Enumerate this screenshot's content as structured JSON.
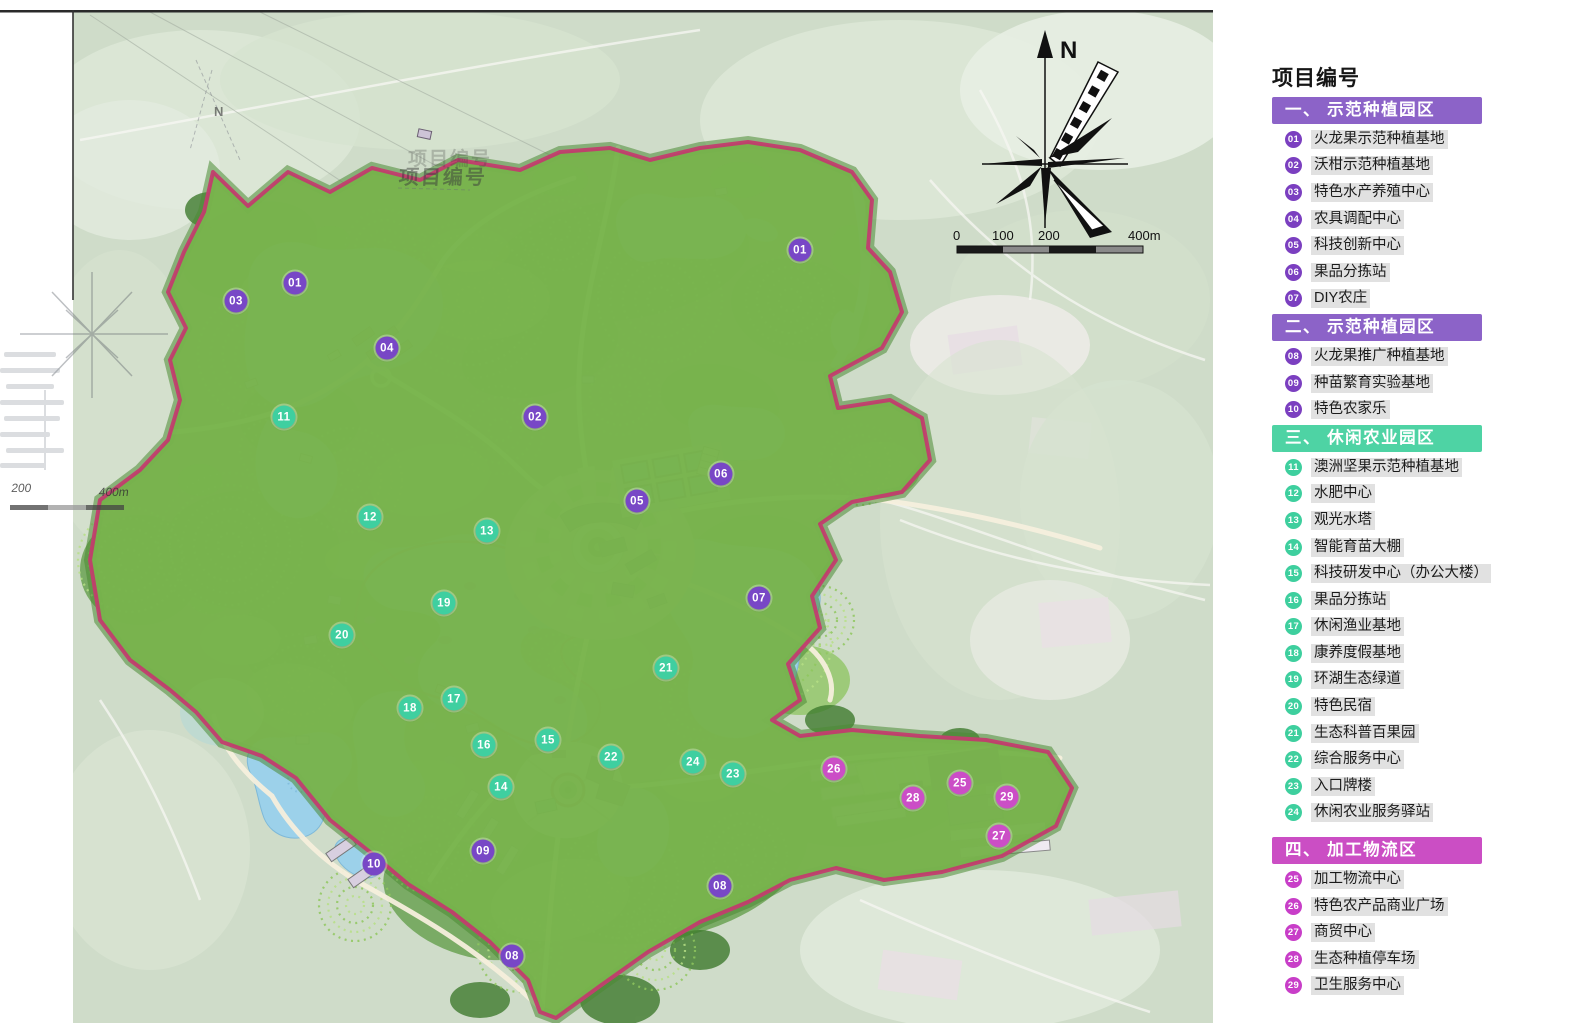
{
  "map": {
    "compass_label": "N",
    "scalebar": {
      "l0": "0",
      "l1": "100",
      "l2": "200",
      "l3": "400m"
    },
    "ghost": {
      "title_line1": "项目编号",
      "title_line2": "项目编号",
      "north_label": "N",
      "scale_200": "200",
      "scale_400": "400m"
    },
    "marker_colors": {
      "purple": "#7847c6",
      "teal": "#3fcfa0",
      "magenta": "#cb4ec6"
    },
    "markers": [
      {
        "id": "01",
        "group": "purple",
        "x": 295,
        "y": 283
      },
      {
        "id": "01",
        "group": "purple",
        "x": 800,
        "y": 250
      },
      {
        "id": "02",
        "group": "purple",
        "x": 535,
        "y": 417
      },
      {
        "id": "03",
        "group": "purple",
        "x": 236,
        "y": 301
      },
      {
        "id": "04",
        "group": "purple",
        "x": 387,
        "y": 348
      },
      {
        "id": "05",
        "group": "purple",
        "x": 637,
        "y": 501
      },
      {
        "id": "06",
        "group": "purple",
        "x": 721,
        "y": 474
      },
      {
        "id": "07",
        "group": "purple",
        "x": 759,
        "y": 598
      },
      {
        "id": "08",
        "group": "purple",
        "x": 720,
        "y": 886
      },
      {
        "id": "08",
        "group": "purple",
        "x": 512,
        "y": 956
      },
      {
        "id": "09",
        "group": "purple",
        "x": 483,
        "y": 851
      },
      {
        "id": "10",
        "group": "purple",
        "x": 374,
        "y": 864
      },
      {
        "id": "11",
        "group": "teal",
        "x": 284,
        "y": 417
      },
      {
        "id": "12",
        "group": "teal",
        "x": 370,
        "y": 517
      },
      {
        "id": "13",
        "group": "teal",
        "x": 487,
        "y": 531
      },
      {
        "id": "14",
        "group": "teal",
        "x": 501,
        "y": 787
      },
      {
        "id": "15",
        "group": "teal",
        "x": 548,
        "y": 740
      },
      {
        "id": "16",
        "group": "teal",
        "x": 484,
        "y": 745
      },
      {
        "id": "17",
        "group": "teal",
        "x": 454,
        "y": 699
      },
      {
        "id": "18",
        "group": "teal",
        "x": 410,
        "y": 708
      },
      {
        "id": "19",
        "group": "teal",
        "x": 444,
        "y": 603
      },
      {
        "id": "20",
        "group": "teal",
        "x": 342,
        "y": 635
      },
      {
        "id": "21",
        "group": "teal",
        "x": 666,
        "y": 668
      },
      {
        "id": "22",
        "group": "teal",
        "x": 611,
        "y": 757
      },
      {
        "id": "23",
        "group": "teal",
        "x": 733,
        "y": 774
      },
      {
        "id": "24",
        "group": "teal",
        "x": 693,
        "y": 762
      },
      {
        "id": "25",
        "group": "magenta",
        "x": 960,
        "y": 783
      },
      {
        "id": "26",
        "group": "magenta",
        "x": 834,
        "y": 769
      },
      {
        "id": "27",
        "group": "magenta",
        "x": 999,
        "y": 836
      },
      {
        "id": "28",
        "group": "magenta",
        "x": 913,
        "y": 798
      },
      {
        "id": "29",
        "group": "magenta",
        "x": 1007,
        "y": 797
      }
    ]
  },
  "legend": {
    "title": "项目编号",
    "circle_colors": {
      "purple": "#7b3fc0",
      "teal": "#3ecf9e",
      "magenta": "#c83ec8"
    },
    "sections": [
      {
        "heading": "一、 示范种植园区",
        "color": "#8c63c8",
        "group": "purple",
        "items": [
          {
            "id": "01",
            "label": "火龙果示范种植基地"
          },
          {
            "id": "02",
            "label": "沃柑示范种植基地"
          },
          {
            "id": "03",
            "label": "特色水产养殖中心"
          },
          {
            "id": "04",
            "label": "农具调配中心"
          },
          {
            "id": "05",
            "label": "科技创新中心"
          },
          {
            "id": "06",
            "label": "果品分拣站"
          },
          {
            "id": "07",
            "label": "DIY农庄"
          }
        ]
      },
      {
        "heading": "二、 示范种植园区",
        "color": "#8c63c8",
        "group": "purple",
        "items": [
          {
            "id": "08",
            "label": "火龙果推广种植基地"
          },
          {
            "id": "09",
            "label": "种苗繁育实验基地"
          },
          {
            "id": "10",
            "label": "特色农家乐"
          }
        ]
      },
      {
        "heading": "三、 休闲农业园区",
        "color": "#4ed3a4",
        "group": "teal",
        "items": [
          {
            "id": "11",
            "label": "澳洲坚果示范种植基地"
          },
          {
            "id": "12",
            "label": "水肥中心"
          },
          {
            "id": "13",
            "label": "观光水塔"
          },
          {
            "id": "14",
            "label": "智能育苗大棚"
          },
          {
            "id": "15",
            "label": "科技研发中心（办公大楼）"
          },
          {
            "id": "16",
            "label": "果品分拣站"
          },
          {
            "id": "17",
            "label": "休闲渔业基地"
          },
          {
            "id": "18",
            "label": "康养度假基地"
          },
          {
            "id": "19",
            "label": "环湖生态绿道"
          },
          {
            "id": "20",
            "label": "特色民宿"
          },
          {
            "id": "21",
            "label": "生态科普百果园"
          },
          {
            "id": "22",
            "label": "综合服务中心"
          },
          {
            "id": "23",
            "label": "入口牌楼"
          },
          {
            "id": "24",
            "label": "休闲农业服务驿站"
          }
        ]
      },
      {
        "heading": "四、 加工物流区",
        "color": "#cb4ec4",
        "group": "magenta",
        "items": [
          {
            "id": "25",
            "label": "加工物流中心"
          },
          {
            "id": "26",
            "label": "特色农产品商业广场"
          },
          {
            "id": "27",
            "label": "商贸中心"
          },
          {
            "id": "28",
            "label": "生态种植停车场"
          },
          {
            "id": "29",
            "label": "卫生服务中心"
          }
        ]
      }
    ]
  }
}
